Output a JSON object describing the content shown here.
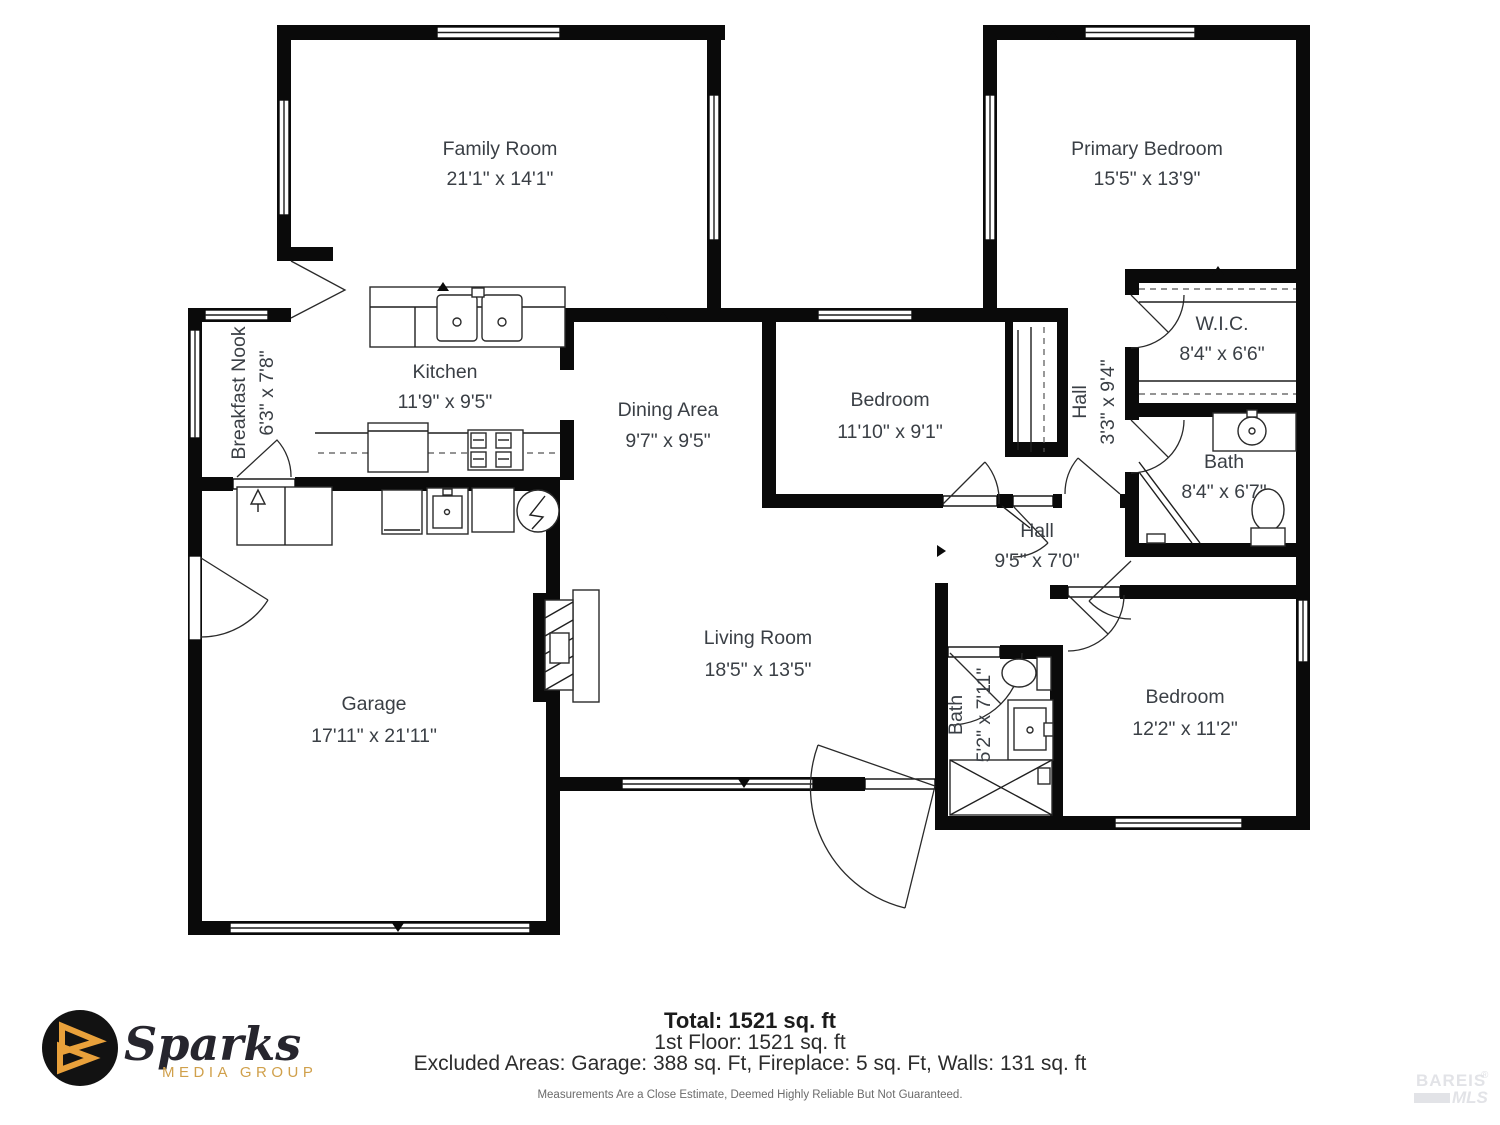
{
  "plan": {
    "rooms": [
      {
        "name": "Family Room",
        "dims": "21'1\" x 14'1\""
      },
      {
        "name": "Primary Bedroom",
        "dims": "15'5\" x 13'9\""
      },
      {
        "name": "Breakfast Nook",
        "dims": "6'3\" x 7'8\""
      },
      {
        "name": "Kitchen",
        "dims": "11'9\" x 9'5\""
      },
      {
        "name": "Dining Area",
        "dims": "9'7\" x 9'5\""
      },
      {
        "name": "Bedroom",
        "dims": "11'10\" x 9'1\""
      },
      {
        "name": "Hall",
        "dims": "3'3\" x 9'4\""
      },
      {
        "name": "W.I.C.",
        "dims": "8'4\" x 6'6\""
      },
      {
        "name": "Bath",
        "dims": "8'4\" x 6'7\""
      },
      {
        "name": "Hall",
        "dims": "9'5\" x 7'0\""
      },
      {
        "name": "Living Room",
        "dims": "18'5\" x 13'5\""
      },
      {
        "name": "Garage",
        "dims": "17'11\" x 21'11\""
      },
      {
        "name": "Bath",
        "dims": "5'2\" x 7'11\""
      },
      {
        "name": "Bedroom",
        "dims": "12'2\" x 11'2\""
      }
    ]
  },
  "footer": {
    "total": "Total: 1521 sq. ft",
    "floor": "1st Floor: 1521 sq. ft",
    "excluded": "Excluded Areas: Garage: 388 sq. Ft, Fireplace: 5 sq. Ft, Walls: 131 sq. ft",
    "disclaimer": "Measurements Are a Close Estimate, Deemed Highly Reliable But Not Guaranteed."
  },
  "logo": {
    "brand": "Sparks",
    "tagline": "MEDIA GROUP"
  },
  "watermark": {
    "line1": "BAREIS",
    "reg": "®",
    "line2": "MLS"
  },
  "colors": {
    "wall": "#0a0a0a",
    "text": "#3a3f45",
    "logo_gold": "#E9A13B",
    "tagline_gold": "#D0A04B",
    "watermark": "#e2e3e7"
  }
}
